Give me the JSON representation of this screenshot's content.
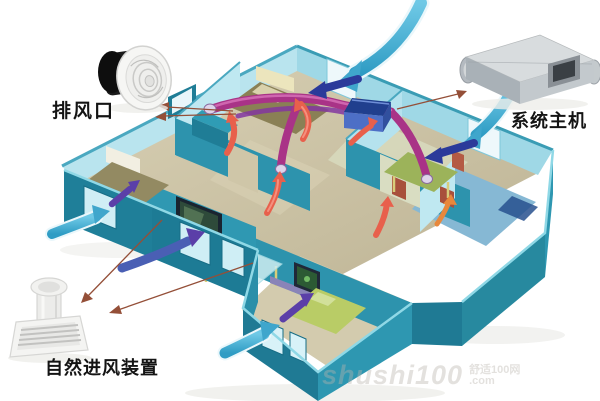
{
  "callouts": {
    "exhaust_vent_label": "排风口",
    "system_unit_label": "系统主机",
    "air_intake_label": "自然进风装置"
  },
  "watermark": {
    "brand": "shushi100",
    "site_name": "舒适100网",
    "domain": ".com"
  },
  "colors": {
    "wall_outer_teal": "#1f7f99",
    "wall_mid_teal": "#2f9cb5",
    "wall_inner_light": "#b9e4ee",
    "floor_tan": "#cfc6a8",
    "bathroom_floor_blue": "#86b8d4",
    "duct_magenta": "#a93387",
    "fresh_air_cyan": "#46b2d8",
    "indoor_air_blue": "#2b3a9a",
    "indoor_air_purple": "#5b3fa8",
    "exhaust_air_red": "#e8604c",
    "ceiling_unit_blue": "#4d6fc6",
    "callout_line_brown": "#944f38"
  }
}
